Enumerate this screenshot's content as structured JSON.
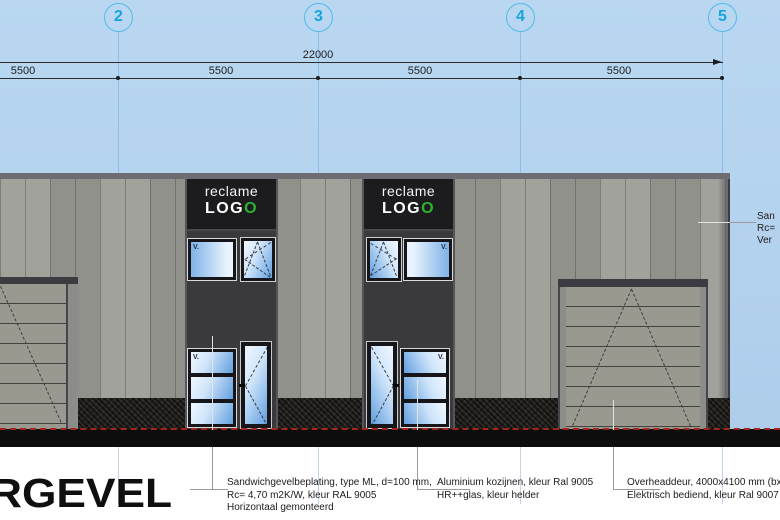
{
  "title": "RGEVEL",
  "grid": [
    "2",
    "3",
    "4",
    "5"
  ],
  "dims": {
    "total": "22000",
    "bays": [
      "5500",
      "5500",
      "5500",
      "5500"
    ]
  },
  "sign": {
    "reclame": "reclame",
    "logo_prefix": "LOG",
    "logo_suffix": "O"
  },
  "labels": {
    "vent": "V."
  },
  "annotations": {
    "panel": [
      "Sandwichgevelbeplating, type ML, d=100 mm,",
      "Rc= 4,70 m2K/W, kleur  RAL 9005",
      "Horizontaal gemonteerd"
    ],
    "frames": [
      "Aluminium kozijnen, kleur Ral 9005",
      "HR++glas, kleur helder"
    ],
    "overhead": [
      "Overheaddeur, 4000x4100 mm (bxh)",
      "Elektrisch bediend, kleur Ral 9007"
    ],
    "right_truncated": [
      "San",
      "Rc=",
      "Ver"
    ]
  },
  "colors": {
    "sky": "#b5d3ee",
    "grid_accent": "#2fadde",
    "logo_green": "#2db233",
    "cladding": "#9c9c97",
    "dark_panel": "#3a3a3d",
    "ground_red": "#a3241b"
  }
}
